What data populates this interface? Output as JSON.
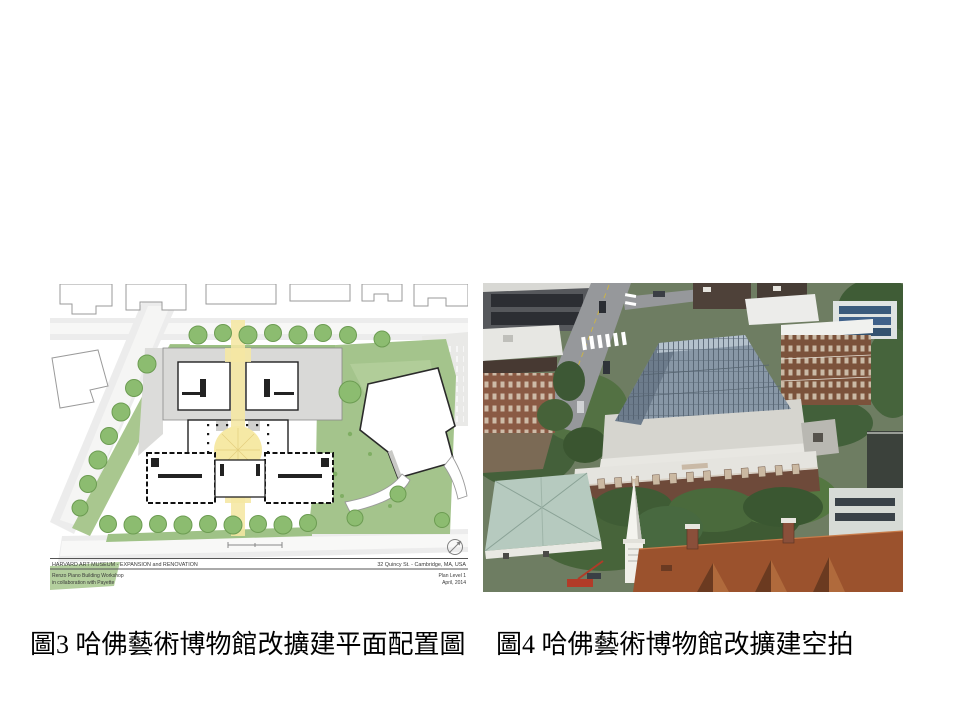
{
  "slide": {
    "background": "#ffffff"
  },
  "plan_figure": {
    "caption": "圖3 哈佛藝術博物館改擴建平面配置圖",
    "title_block": {
      "project": "HARVARD ART MUSEUM - EXPANSION and RENOVATION",
      "address": "32 Quincy St. - Cambridge, MA, USA",
      "architect": "Renzo Piano Building Workshop",
      "collaboration": "in collaboration with Payette",
      "sheet_name": "Plan Level 1",
      "date": "April, 2014"
    },
    "palette": {
      "courtyard_yellow": "#F5E7A3",
      "tree_green": "#8CBC70",
      "lawn_green": "#A4C48C",
      "street_gray": "#ECECEC",
      "wall_black": "#1A1A1A"
    }
  },
  "photo_figure": {
    "caption": "圖4 哈佛藝術博物館改擴建空拍",
    "palette": {
      "glass_roof": "#8897A6",
      "brick_facade": "#6E4A3A",
      "red_roof": "#9B522D",
      "teal_roof": "#B6CABF",
      "foliage": "#44603A",
      "asphalt": "#96989B"
    }
  }
}
